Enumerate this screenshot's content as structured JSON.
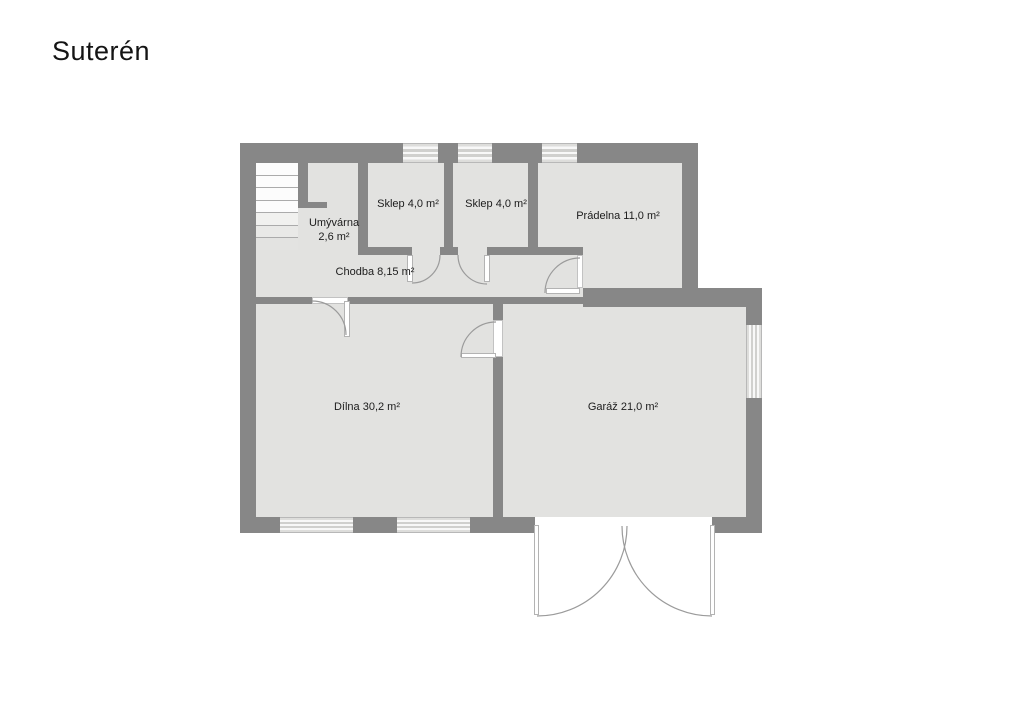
{
  "title": "Suterén",
  "floorplan": {
    "type": "floor-plan",
    "floor_name": "Suterén",
    "rooms": [
      {
        "name": "Umývárna",
        "area": "2,6 m²",
        "line1": "Umývárna",
        "line2": "2,6 m²"
      },
      {
        "name": "Sklep",
        "area": "4,0 m²",
        "label": "Sklep 4,0 m²"
      },
      {
        "name": "Sklep",
        "area": "4,0 m²",
        "label": "Sklep 4,0 m²"
      },
      {
        "name": "Prádelna",
        "area": "11,0 m²",
        "label": "Prádelna 11,0 m²"
      },
      {
        "name": "Chodba",
        "area": "8,15 m²",
        "label": "Chodba 8,15 m²"
      },
      {
        "name": "Dílna",
        "area": "30,2 m²",
        "label": "Dílna 30,2 m²"
      },
      {
        "name": "Garáž",
        "area": "21,0 m²",
        "label": "Garáž 21,0 m²"
      }
    ],
    "features": {
      "staircase_treads": 7,
      "windows": 6,
      "doors": 5,
      "garage_double_door": 1
    },
    "colors": {
      "wall": "#878787",
      "floor": "#e2e2e0",
      "background": "#ffffff",
      "window_light": "#f8f8f8",
      "window_mid": "#d0d0ce",
      "door_arc": "#9b9b9b",
      "text": "#1c1c1c"
    }
  }
}
